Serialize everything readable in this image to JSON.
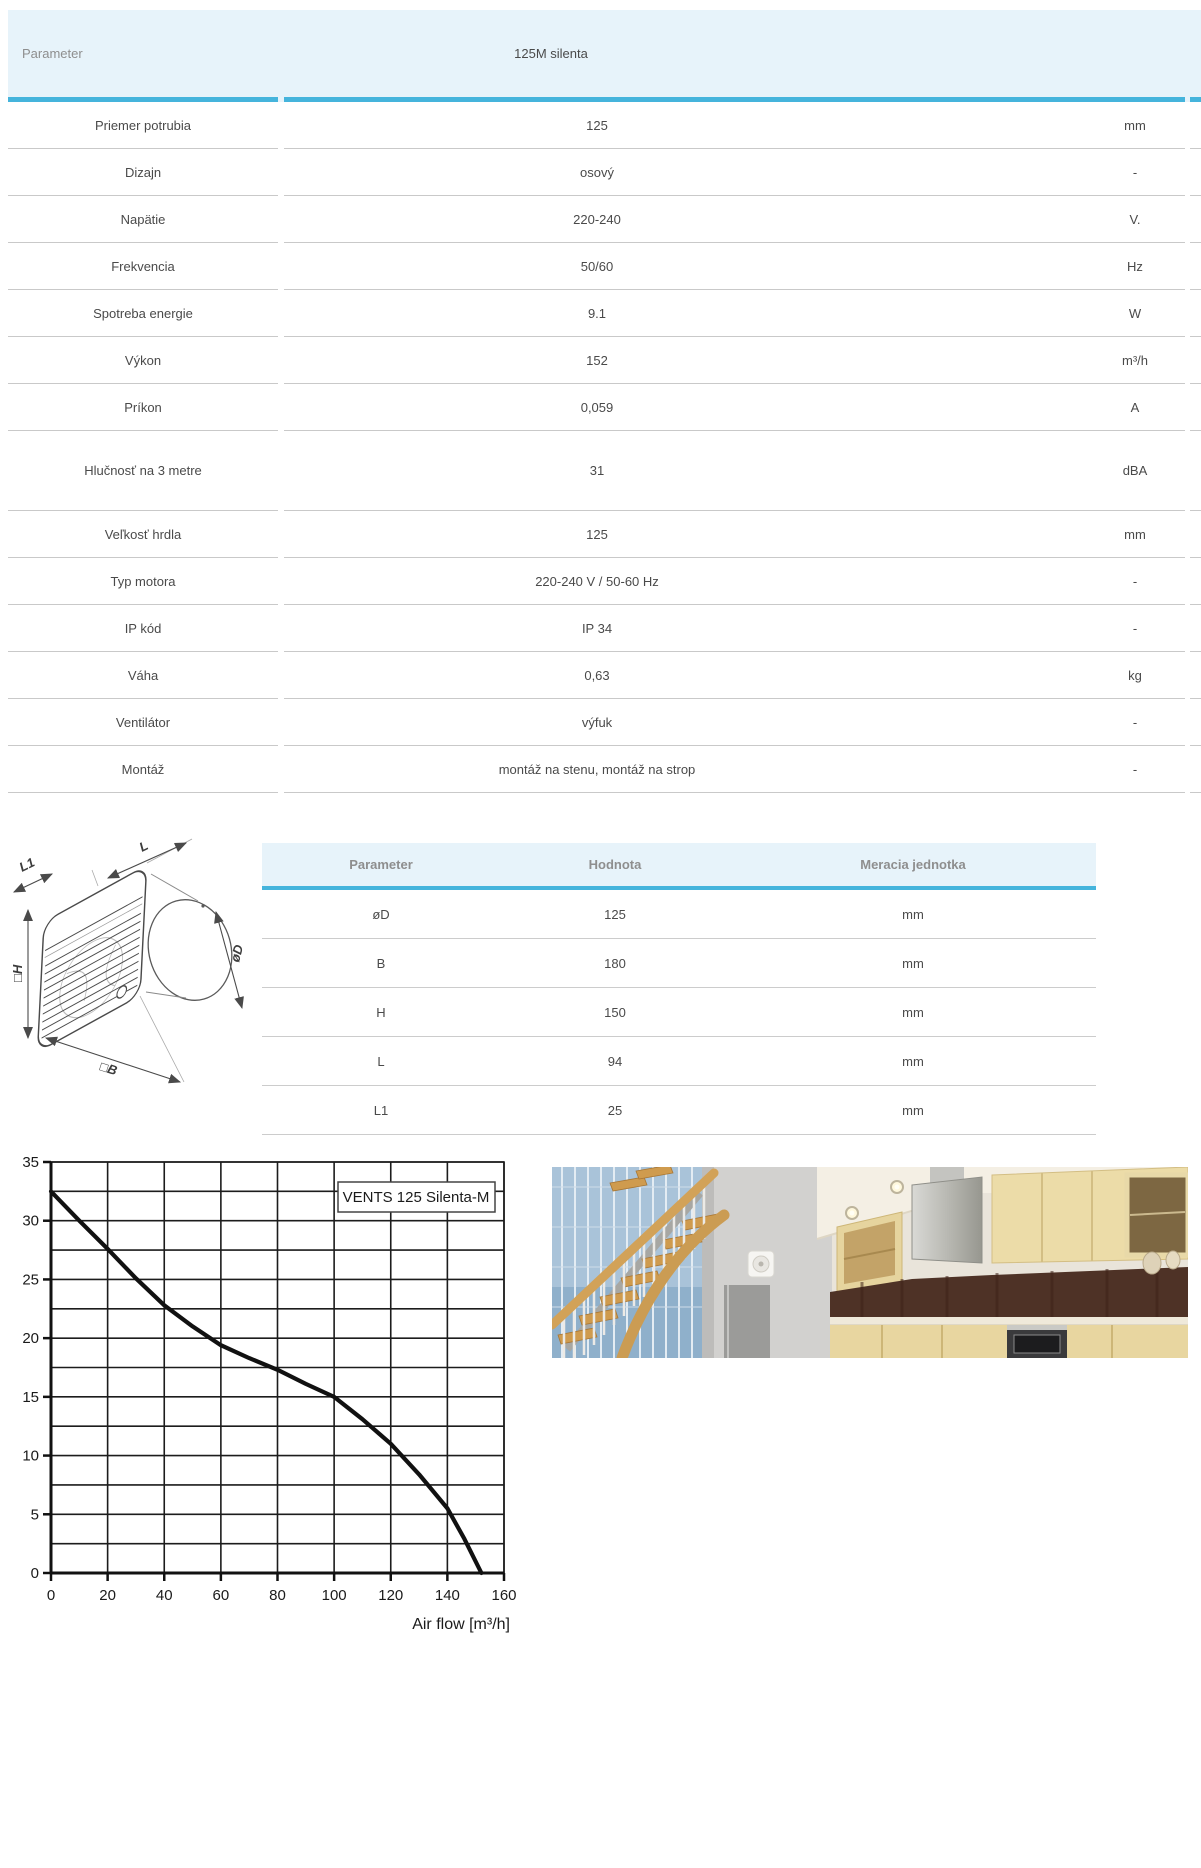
{
  "colors": {
    "accent_line": "#45b4dc",
    "header_bg": "#e7f3fa",
    "separator": "#c9c9c9",
    "chart_line": "#111111"
  },
  "spec_table": {
    "header": {
      "parameter": "Parameter",
      "product": "125M silenta"
    },
    "rows": [
      {
        "label": "Priemer potrubia",
        "value": "125",
        "unit": "mm"
      },
      {
        "label": "Dizajn",
        "value": "osový",
        "unit": "-"
      },
      {
        "label": "Napätie",
        "value": "220-240",
        "unit": "V."
      },
      {
        "label": "Frekvencia",
        "value": "50/60",
        "unit": "Hz"
      },
      {
        "label": "Spotreba energie",
        "value": "9.1",
        "unit": "W"
      },
      {
        "label": "Výkon",
        "value": "152",
        "unit": "m³/h"
      },
      {
        "label": "Príkon",
        "value": "0,059",
        "unit": "A"
      },
      {
        "label": "Hlučnosť na 3 metre",
        "value": "31",
        "unit": "dBA",
        "tall": true
      },
      {
        "label": "Veľkosť hrdla",
        "value": "125",
        "unit": "mm"
      },
      {
        "label": "Typ motora",
        "value": "220-240 V / 50-60 Hz",
        "unit": "-"
      },
      {
        "label": "IP kód",
        "value": "IP 34",
        "unit": "-"
      },
      {
        "label": "Váha",
        "value": "0,63",
        "unit": "kg"
      },
      {
        "label": "Ventilátor",
        "value": "výfuk",
        "unit": "-"
      },
      {
        "label": "Montáž",
        "value": "montáž na stenu, montáž na strop",
        "unit": "-"
      }
    ]
  },
  "dimensions_table": {
    "headers": [
      "Parameter",
      "Hodnota",
      "Meracia jednotka"
    ],
    "rows": [
      {
        "param": "øD",
        "value": "125",
        "unit": "mm"
      },
      {
        "param": "B",
        "value": "180",
        "unit": "mm"
      },
      {
        "param": "H",
        "value": "150",
        "unit": "mm"
      },
      {
        "param": "L",
        "value": "94",
        "unit": "mm"
      },
      {
        "param": "L1",
        "value": "25",
        "unit": "mm"
      }
    ]
  },
  "diagram": {
    "labels": {
      "l1": "L1",
      "l": "L",
      "h": "□H",
      "d": "øD",
      "b": "□B"
    }
  },
  "chart_data": {
    "type": "line",
    "title": "",
    "xlabel": "Air flow [m³/h]",
    "ylabel": "",
    "xlim": [
      0,
      160
    ],
    "ylim": [
      0,
      35
    ],
    "x_ticks": [
      0,
      20,
      40,
      60,
      80,
      100,
      120,
      140,
      160
    ],
    "y_ticks": [
      0,
      5,
      10,
      15,
      20,
      25,
      30,
      35
    ],
    "x_grid_step": 20,
    "y_grid_step": 2.5,
    "grid": true,
    "legend": "VENTS 125 Silenta-M",
    "legend_position": "top-right",
    "series": [
      {
        "name": "VENTS 125 Silenta-M",
        "points": [
          [
            0,
            32.5
          ],
          [
            10,
            30.0
          ],
          [
            20,
            27.6
          ],
          [
            30,
            25.1
          ],
          [
            40,
            22.8
          ],
          [
            50,
            21.0
          ],
          [
            60,
            19.4
          ],
          [
            70,
            18.3
          ],
          [
            80,
            17.3
          ],
          [
            90,
            16.1
          ],
          [
            100,
            15.0
          ],
          [
            110,
            13.1
          ],
          [
            120,
            11.0
          ],
          [
            130,
            8.4
          ],
          [
            140,
            5.5
          ],
          [
            146,
            2.9
          ],
          [
            152,
            0
          ]
        ]
      }
    ]
  },
  "photo": {
    "alt": "kitchen-with-wooden-staircase"
  }
}
